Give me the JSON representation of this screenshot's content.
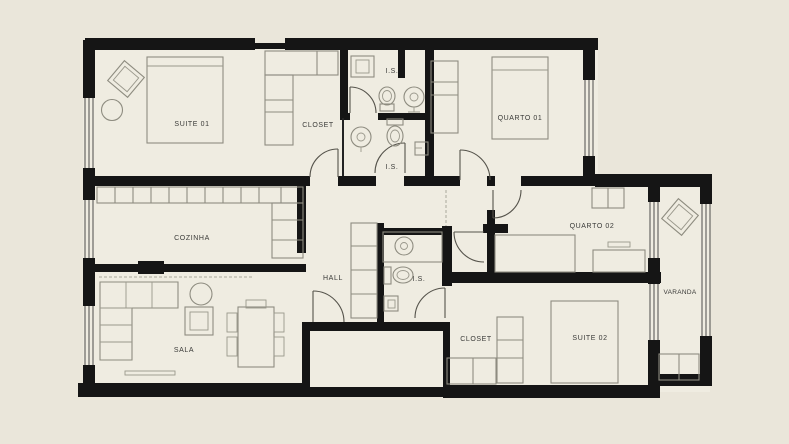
{
  "title": "Apartment floor plan",
  "colors": {
    "canvas_background": "#eae6da",
    "floor": "#efece1",
    "wall": "#151515",
    "furniture_line": "#8e8c80",
    "door_line": "#55534b",
    "label_text": "#3a3a38"
  },
  "rooms": {
    "suite01": "SUITE 01",
    "closet01": "CLOSET",
    "is_top": "I.S.",
    "quarto01": "QUARTO 01",
    "cozinha": "COZINHA",
    "is_mid": "I.S.",
    "hall": "HALL",
    "quarto02": "QUARTO 02",
    "is_service": "I.S.",
    "varanda": "VARANDA",
    "sala": "SALA",
    "closet02": "CLOSET",
    "suite02": "SUITE 02"
  }
}
